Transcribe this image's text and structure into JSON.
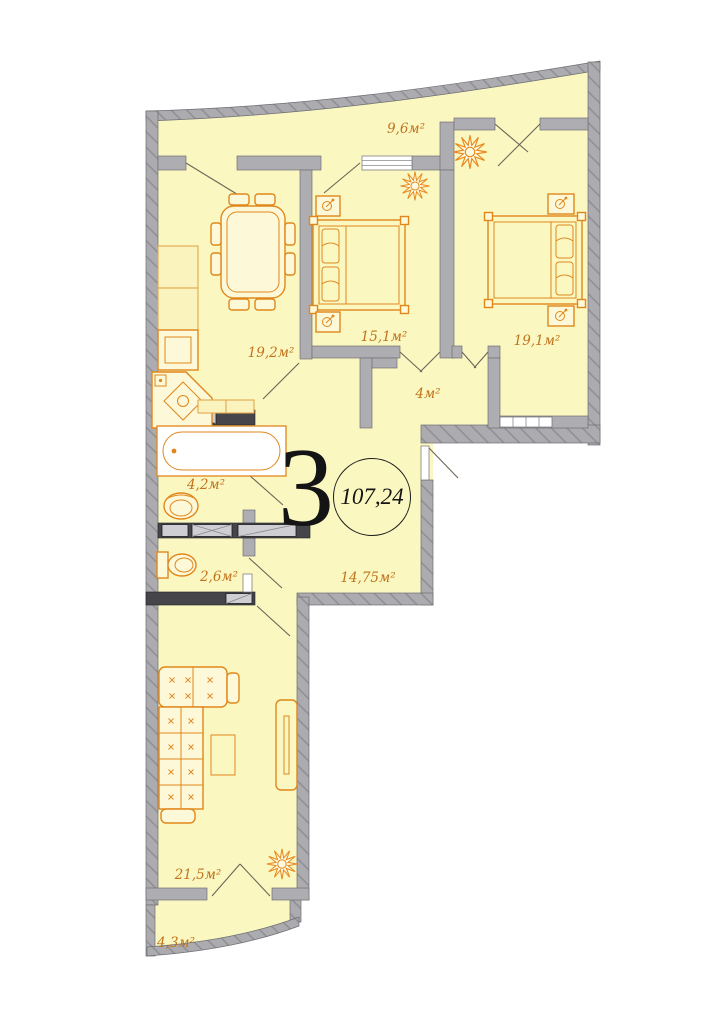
{
  "plan": {
    "rooms_count": "3",
    "total_area": "107,24",
    "rooms": [
      {
        "id": "loggia-top",
        "area": "9,6м²"
      },
      {
        "id": "kitchen-dining",
        "area": "19,2м²"
      },
      {
        "id": "bedroom-middle",
        "area": "15,1м²"
      },
      {
        "id": "bedroom-right",
        "area": "19,1м²"
      },
      {
        "id": "corridor",
        "area": "4м²"
      },
      {
        "id": "bathroom",
        "area": "4,2м²"
      },
      {
        "id": "wc",
        "area": "2,6м²"
      },
      {
        "id": "hallway",
        "area": "14,75м²"
      },
      {
        "id": "living-room",
        "area": "21,5м²"
      },
      {
        "id": "balcony-bottom",
        "area": "4,3м²"
      }
    ],
    "colors": {
      "floor_fill": "#FAF7C0",
      "wall_gray": "#ACACB0",
      "furniture_orange": "#E0871C",
      "label_orange": "#C0731D"
    }
  }
}
